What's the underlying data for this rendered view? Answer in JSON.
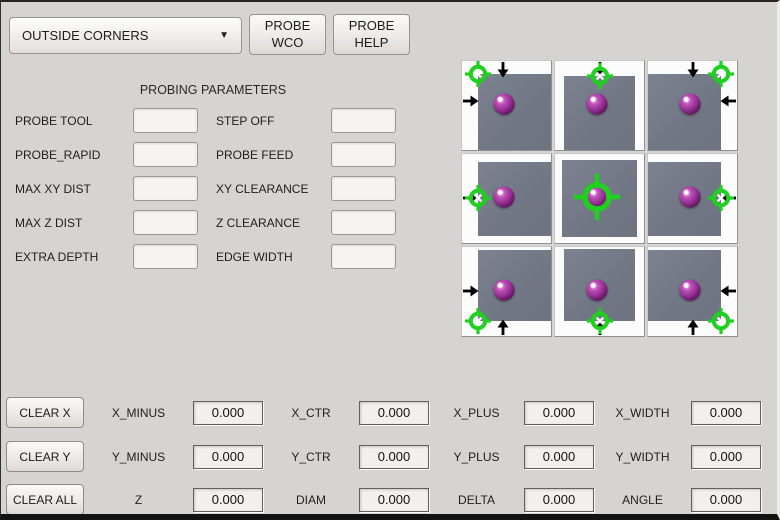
{
  "colors": {
    "window_bg": "#d5d4d2",
    "crosshair_green": "#1fd11f",
    "sphere_purple": "#993399",
    "workpiece_gray": "#747a86"
  },
  "header": {
    "mode_dropdown": {
      "value": "OUTSIDE CORNERS",
      "icon": "chevron-down"
    },
    "probe_wco_label": "PROBE\nWCO",
    "probe_help_label": "PROBE\nHELP"
  },
  "parameters": {
    "title": "PROBING PARAMETERS",
    "rows": [
      {
        "left_label": "PROBE TOOL",
        "left_value": "",
        "right_label": "STEP OFF",
        "right_value": ""
      },
      {
        "left_label": "PROBE_RAPID",
        "left_value": "",
        "right_label": "PROBE FEED",
        "right_value": ""
      },
      {
        "left_label": "MAX XY DIST",
        "left_value": "",
        "right_label": "XY CLEARANCE",
        "right_value": ""
      },
      {
        "left_label": "MAX Z DIST",
        "left_value": "",
        "right_label": "Z CLEARANCE",
        "right_value": ""
      },
      {
        "left_label": "EXTRA DEPTH",
        "left_value": "",
        "right_label": "EDGE WIDTH",
        "right_value": ""
      }
    ]
  },
  "probe_image": {
    "description": "3x3 grid of outside-corner/edge probing positions; green crosshair target, purple probe ball, black approach arrows on gray workpiece",
    "sphere": {
      "x": 47,
      "y": 48
    },
    "cells": [
      {
        "name": "top-left-corner",
        "square": {
          "left": 18,
          "top": 15,
          "width": 82,
          "height": 85
        },
        "marker": {
          "x": 18,
          "y": 15,
          "big": false
        },
        "arrows": [
          {
            "dir": "down",
            "x": 46,
            "y": 1
          },
          {
            "dir": "right",
            "x": 1,
            "y": 45
          }
        ]
      },
      {
        "name": "top-edge",
        "square": {
          "left": 10,
          "top": 17,
          "width": 80,
          "height": 83
        },
        "marker": {
          "x": 50,
          "y": 17,
          "big": false
        },
        "arrows": [
          {
            "dir": "down",
            "x": 50,
            "y": 1
          }
        ]
      },
      {
        "name": "top-right-corner",
        "square": {
          "left": 0,
          "top": 15,
          "width": 82,
          "height": 85
        },
        "marker": {
          "x": 82,
          "y": 15,
          "big": false
        },
        "arrows": [
          {
            "dir": "down",
            "x": 50,
            "y": 1
          },
          {
            "dir": "left",
            "x": 99,
            "y": 45
          }
        ]
      },
      {
        "name": "left-edge",
        "square": {
          "left": 18,
          "top": 9,
          "width": 82,
          "height": 83
        },
        "marker": {
          "x": 18,
          "y": 49,
          "big": false
        },
        "arrows": [
          {
            "dir": "right",
            "x": 1,
            "y": 49
          }
        ]
      },
      {
        "name": "center",
        "square": {
          "left": 8,
          "top": 7,
          "width": 84,
          "height": 86
        },
        "marker": {
          "x": 47,
          "y": 48,
          "big": true
        },
        "arrows": []
      },
      {
        "name": "right-edge",
        "square": {
          "left": 0,
          "top": 9,
          "width": 82,
          "height": 83
        },
        "marker": {
          "x": 82,
          "y": 49,
          "big": false
        },
        "arrows": [
          {
            "dir": "left",
            "x": 99,
            "y": 49
          }
        ]
      },
      {
        "name": "bottom-left-corner",
        "square": {
          "left": 18,
          "top": 3,
          "width": 82,
          "height": 80
        },
        "marker": {
          "x": 18,
          "y": 83,
          "big": false
        },
        "arrows": [
          {
            "dir": "right",
            "x": 1,
            "y": 49
          },
          {
            "dir": "up",
            "x": 46,
            "y": 99
          }
        ]
      },
      {
        "name": "bottom-edge",
        "square": {
          "left": 10,
          "top": 2,
          "width": 80,
          "height": 81
        },
        "marker": {
          "x": 50,
          "y": 83,
          "big": false
        },
        "arrows": [
          {
            "dir": "up",
            "x": 50,
            "y": 99
          }
        ]
      },
      {
        "name": "bottom-right-corner",
        "square": {
          "left": 0,
          "top": 3,
          "width": 82,
          "height": 80
        },
        "marker": {
          "x": 82,
          "y": 83,
          "big": false
        },
        "arrows": [
          {
            "dir": "left",
            "x": 99,
            "y": 49
          },
          {
            "dir": "up",
            "x": 50,
            "y": 99
          }
        ]
      }
    ]
  },
  "results": {
    "rows": [
      {
        "button": "CLEAR X",
        "fields": [
          {
            "label": "X_MINUS",
            "value": "0.000"
          },
          {
            "label": "X_CTR",
            "value": "0.000"
          },
          {
            "label": "X_PLUS",
            "value": "0.000"
          },
          {
            "label": "X_WIDTH",
            "value": "0.000"
          }
        ]
      },
      {
        "button": "CLEAR Y",
        "fields": [
          {
            "label": "Y_MINUS",
            "value": "0.000"
          },
          {
            "label": "Y_CTR",
            "value": "0.000"
          },
          {
            "label": "Y_PLUS",
            "value": "0.000"
          },
          {
            "label": "Y_WIDTH",
            "value": "0.000"
          }
        ]
      },
      {
        "button": "CLEAR ALL",
        "fields": [
          {
            "label": "Z",
            "value": "0.000"
          },
          {
            "label": "DIAM",
            "value": "0.000"
          },
          {
            "label": "DELTA",
            "value": "0.000"
          },
          {
            "label": "ANGLE",
            "value": "0.000"
          }
        ]
      }
    ]
  }
}
